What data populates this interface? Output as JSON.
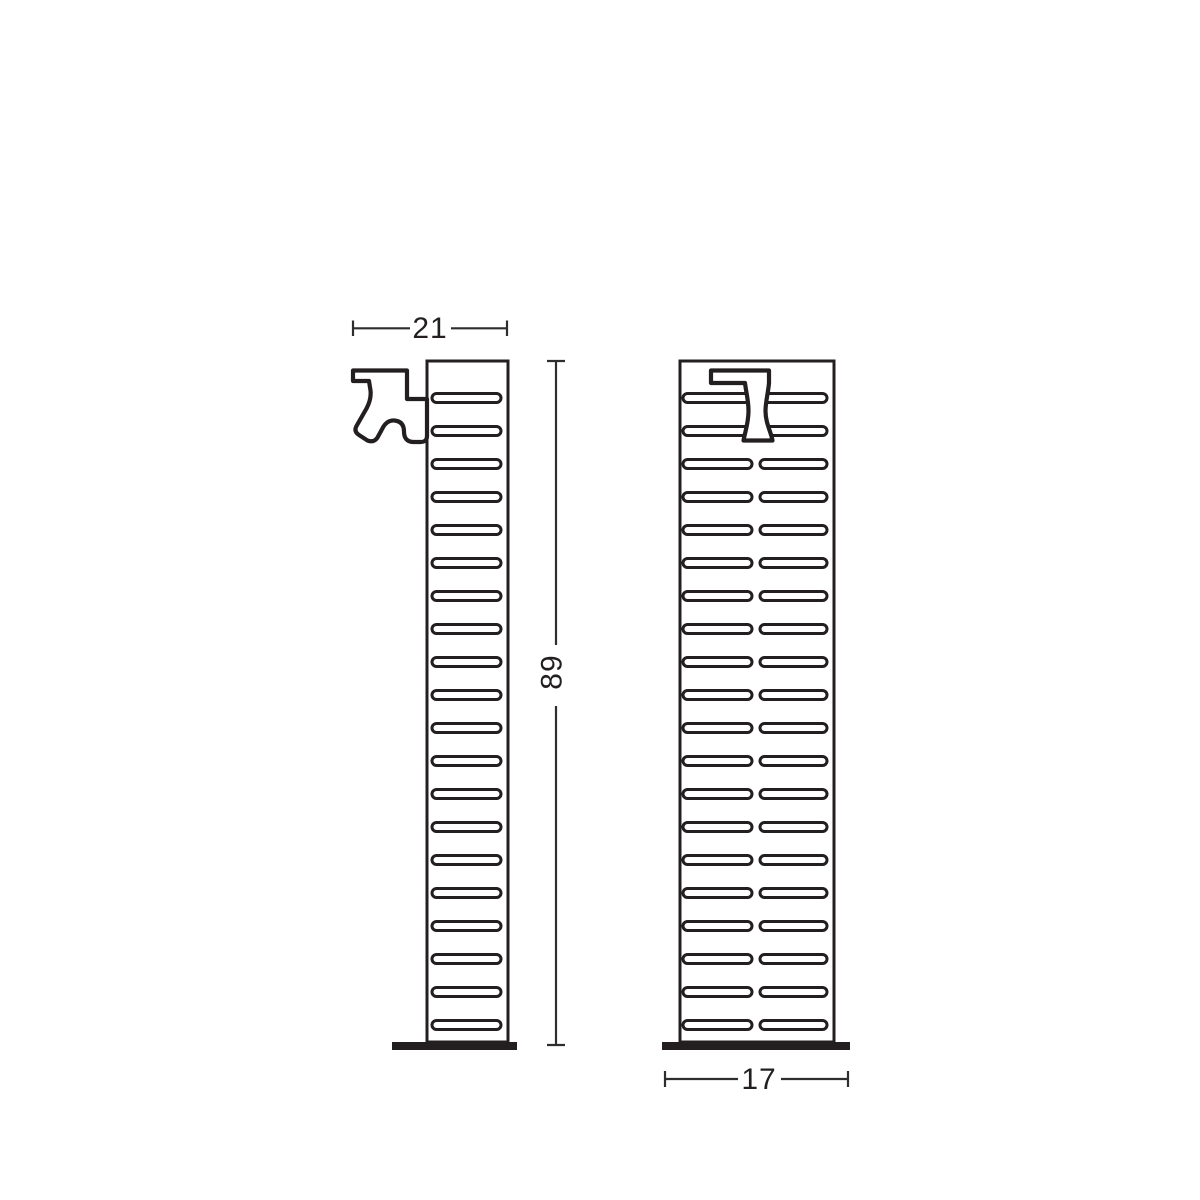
{
  "drawing": {
    "type": "technical-dimension-drawing",
    "dimensions": {
      "width": "21",
      "height": "89",
      "depth": "17"
    },
    "slot_rows": 20,
    "views": {
      "side": {
        "slot_columns": 1
      },
      "front": {
        "slot_columns": 2
      }
    },
    "icons": [
      "tap-side-icon",
      "tap-front-icon"
    ],
    "colors": {
      "line": "#231f20",
      "dimension_line": "#2e2e2e",
      "background": "#ffffff",
      "base_fill": "#231f20"
    }
  }
}
